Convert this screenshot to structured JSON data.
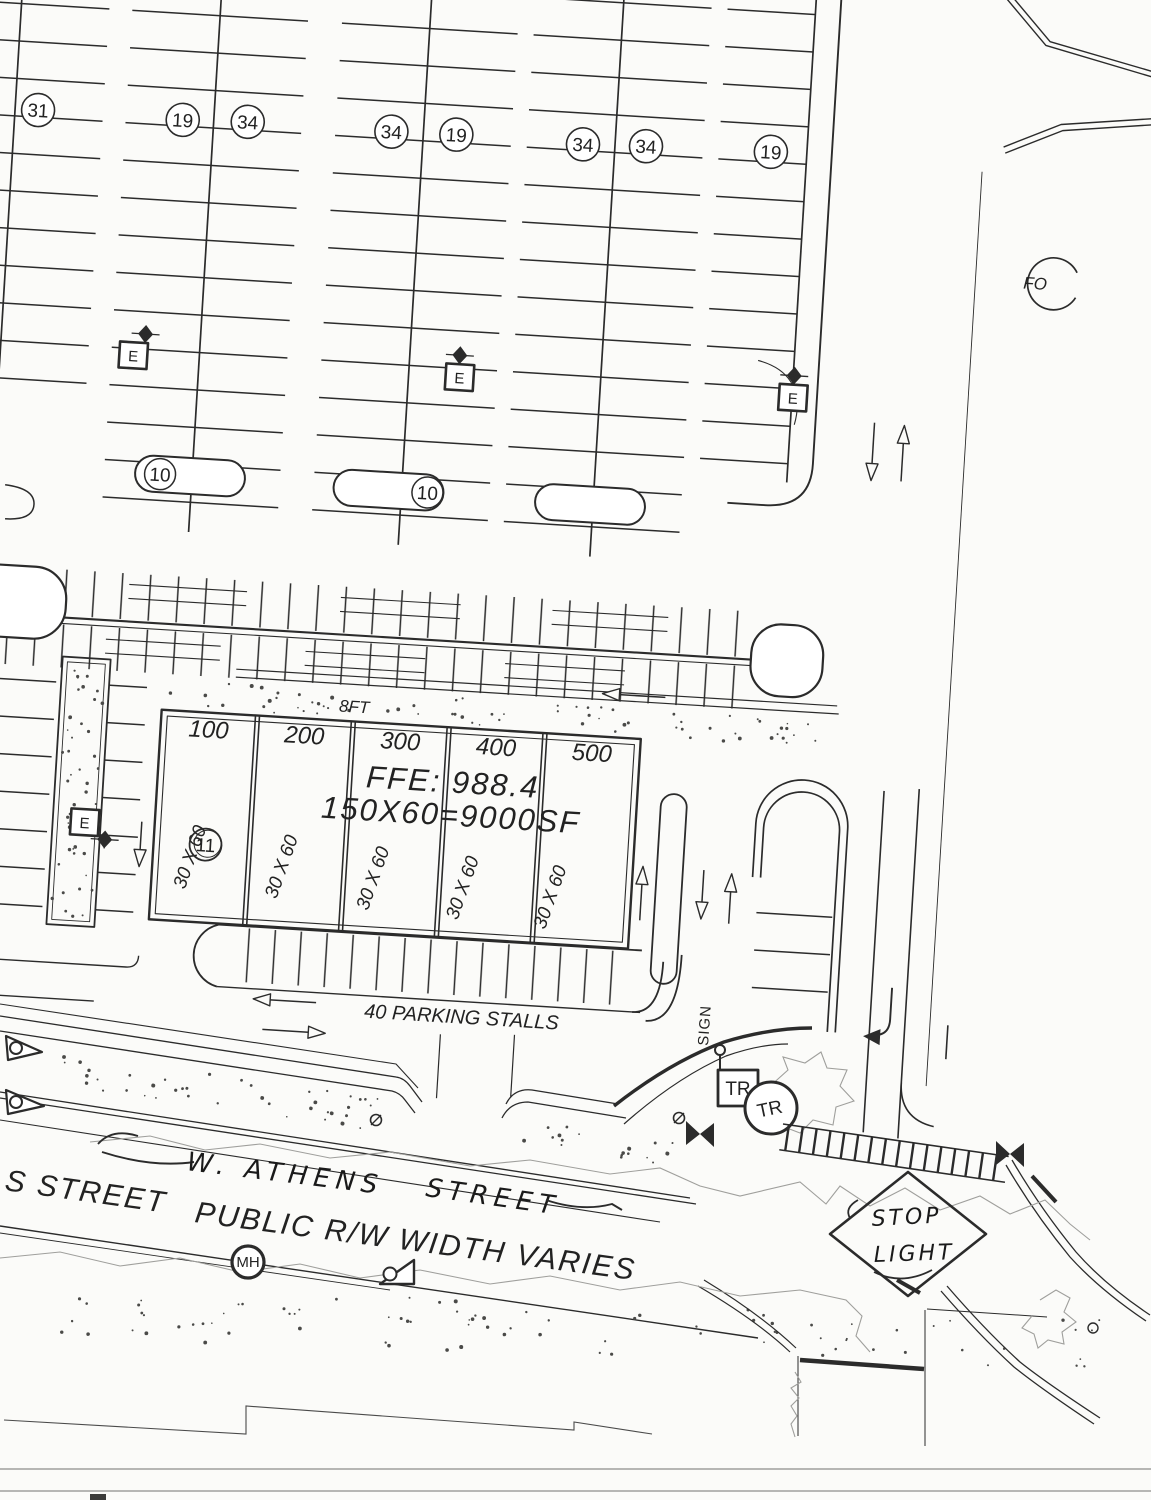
{
  "plan": {
    "ink": "#2b2b2b",
    "paper": "#fbfbf9",
    "counts": {
      "c31": "31",
      "c19a": "19",
      "c34a": "34",
      "c34b": "34",
      "c19b": "19",
      "c34c": "34",
      "c34d": "34",
      "c19c": "19"
    },
    "islands": {
      "i10a": "10",
      "i10b": "10",
      "i11": "11"
    },
    "electric": "E",
    "fo": "FO",
    "building": {
      "walk_width": "8FT",
      "bays": [
        "100",
        "200",
        "300",
        "400",
        "500"
      ],
      "bay_size": "30 X 60",
      "ffe": "FFE: 988.4",
      "area": "150X60=9000SF"
    },
    "south_row_label": "40 PARKING STALLS",
    "intersection": {
      "sign": "SIGN",
      "tr": "TR",
      "manhole": "MH"
    },
    "street": {
      "printed_left": "S STREET",
      "handwritten_name_1": "W. ATHENS",
      "handwritten_name_2": "STREET",
      "printed_rw": "PUBLIC R/W WIDTH VARIES"
    },
    "stoplight": {
      "line1": "STOP",
      "line2": "LIGHT"
    }
  }
}
